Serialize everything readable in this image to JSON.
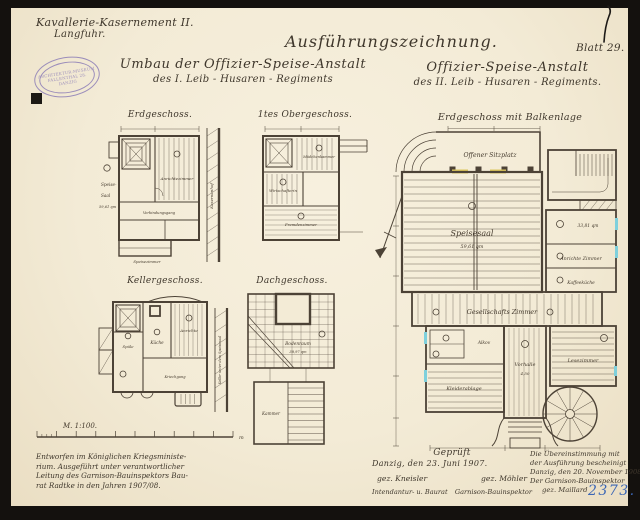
{
  "page": {
    "sheet_label": "Blatt 29.",
    "inventory_number": "2373."
  },
  "header": {
    "site_line1": "Kavallerie-Kasernement II.",
    "site_line2": "Langfuhr.",
    "main_title": "Ausführungszeichnung.",
    "subject_left_line1": "Umbau der Offizier-Speise-Anstalt",
    "subject_left_line2": "des  I.   Leib - Husaren - Regiments",
    "subject_right_line1": "Offizier-Speise-Anstalt",
    "subject_right_line2": "des  II.   Leib - Husaren - Regiments.",
    "stamp": {
      "line1": "ARCHITEKTUR-MUSEUM",
      "line2": "FALLENTHAL 28.",
      "line3": "DANZIG"
    }
  },
  "plans": {
    "erdgeschoss": {
      "title": "Erdgeschoss.",
      "labels": {
        "speise_1": "Speise-",
        "speise_2": "Saal",
        "speise_3": "59,61 qm",
        "anrichte": "Anrichtezimmer",
        "gang": "Verbindungsgang",
        "side": "Kasernenhof",
        "bottom": "Speisezimmer"
      }
    },
    "obergeschoss": {
      "title": "1tes Obergeschoss.",
      "labels": {
        "room1": "Mädchenkammer",
        "room2": "Wirtschafterin",
        "room3": "Fremdenzimmer"
      }
    },
    "kellergeschoss": {
      "title": "Kellergeschoss.",
      "labels": {
        "spuele": "Spüle",
        "kueche": "Küche",
        "anrichte": "Anrichte",
        "gang": "Kriechgang",
        "side": "Keller unter dem Speisesaal"
      }
    },
    "dachgeschoss": {
      "title": "Dachgeschoss.",
      "labels": {
        "boden": "Bodenraum",
        "boden_area": "38,97 qm",
        "kammer": "Kammer"
      }
    },
    "balkenlage": {
      "title": "Erdgeschoss mit Balkenlage",
      "labels": {
        "sitzplatz": "Offener Sitzplatz",
        "speisesaal": "Speisesaal",
        "speisesaal_area": "59,61 qm",
        "anrichte_area": "33,81 qm",
        "anrichte": "Anrichte Zimmer",
        "kaffee": "Kaffeeküche",
        "gesellschaft": "Gesellschafts Zimmer",
        "alkov": "Alkov",
        "kleider": "Kleiderablage",
        "vorhalle": "Vorhalle",
        "vorhalle_dim": "4,50",
        "lese": "Lesezimmer"
      }
    }
  },
  "scale": {
    "label": "M. 1:100.",
    "unit": "m"
  },
  "footer": {
    "left_note": [
      "Entworfen im Königlichen Kriegsministe-",
      "rium.  Ausgeführt unter verantwortlicher",
      "Leitung des Garnison-Bauinspektors Bau-",
      "rat Radtke in den Jahren 1907/08."
    ],
    "approval": {
      "line1": "Geprüft",
      "line2": "Danzig, den 23. Juni 1907.",
      "sig_left": "gez. Kneisler",
      "sig_right": "gez. Möhler",
      "role_left": "Intendantur- u. Baurat",
      "role_right": "Garnison-Bauinspektor"
    },
    "certification": [
      "Die Übereinstimmung mit",
      "der Ausführung bescheinigt",
      "Danzig, den 20. November 1908.",
      "Der Garnison-Bauinspektor",
      "gez. Maillard"
    ]
  },
  "colors": {
    "paper": "#f3ebd6",
    "ink": "#4c4236",
    "stamp_purple": "#8677b5",
    "blue_ink": "#3b66b5",
    "accent_cyan": "#7fd0dc",
    "accent_yellow": "#dcc65c"
  }
}
